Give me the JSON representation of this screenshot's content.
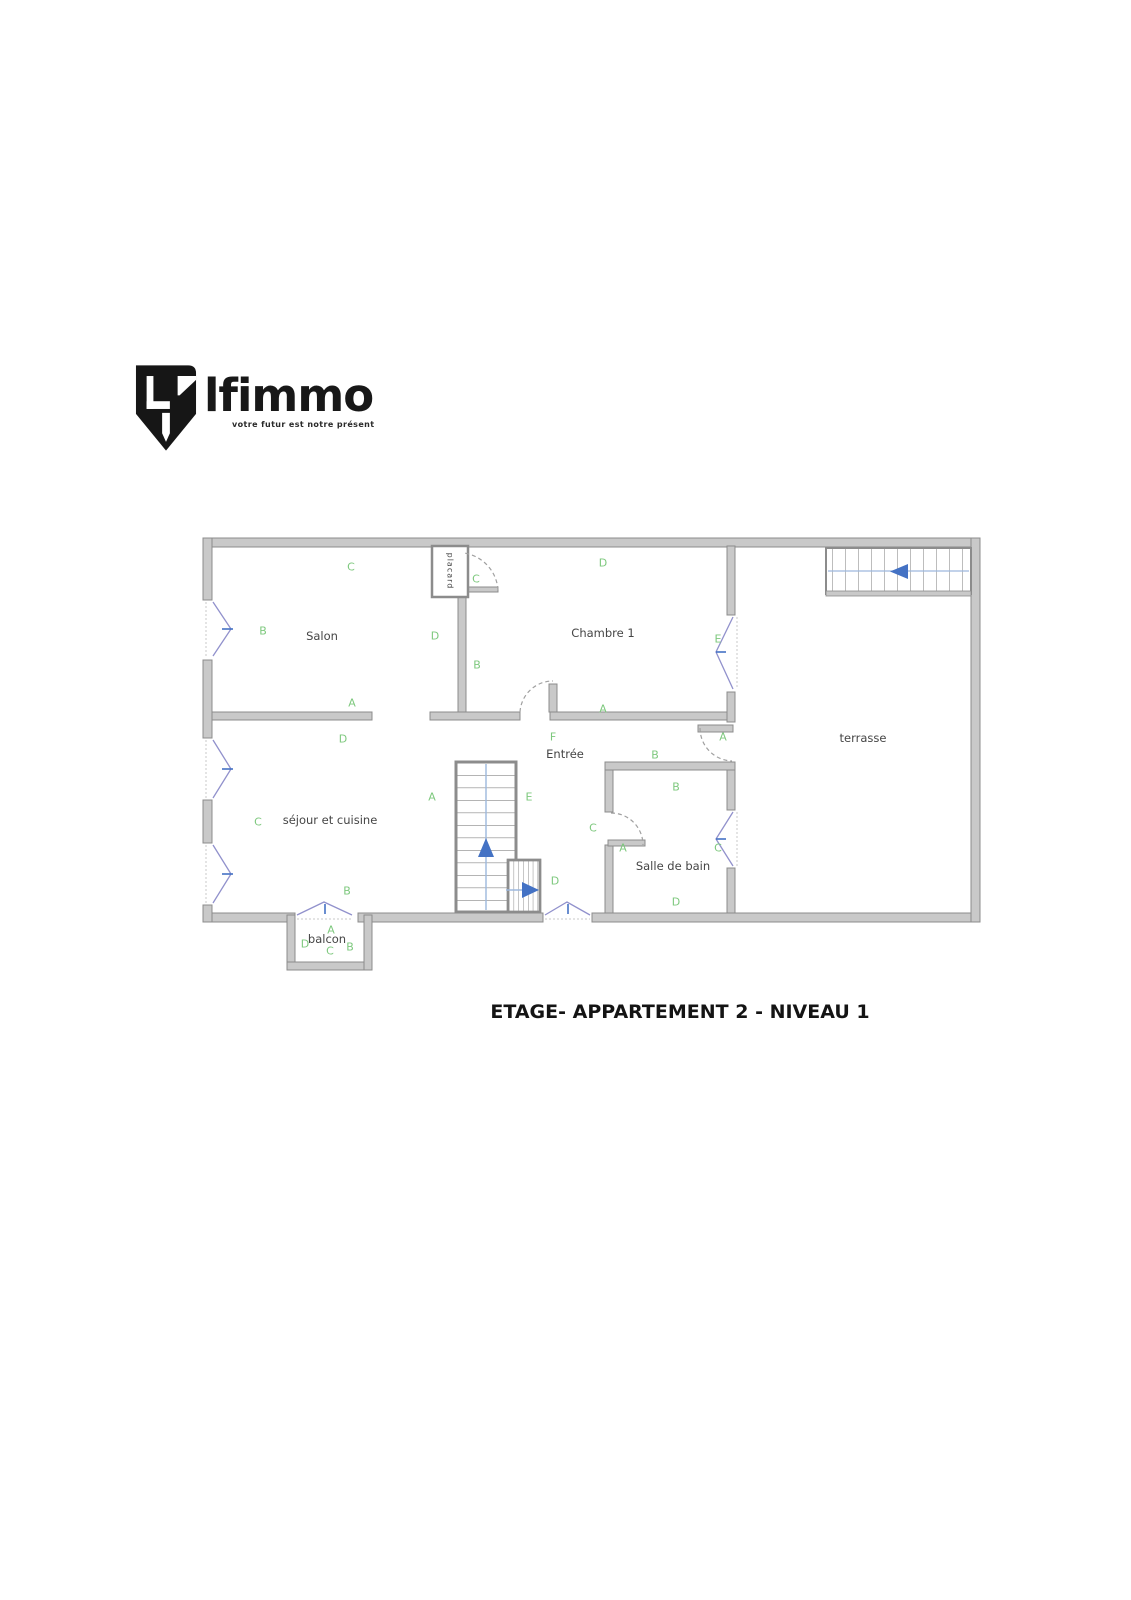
{
  "logo": {
    "brand": "lfimmo",
    "tagline": "votre futur est notre présent"
  },
  "plan": {
    "caption": "ETAGE- APPARTEMENT 2 - NIVEAU 1",
    "rooms": [
      {
        "name": "Salon",
        "x": 322,
        "y": 636
      },
      {
        "name": "Chambre 1",
        "x": 603,
        "y": 633
      },
      {
        "name": "placard",
        "x": 450,
        "y": 571,
        "vertical": true
      },
      {
        "name": "terrasse",
        "x": 863,
        "y": 738
      },
      {
        "name": "Entrée",
        "x": 565,
        "y": 754
      },
      {
        "name": "séjour et cuisine",
        "x": 330,
        "y": 820
      },
      {
        "name": "Salle de bain",
        "x": 673,
        "y": 866
      },
      {
        "name": "balcon",
        "x": 327,
        "y": 939
      }
    ],
    "markers": [
      {
        "letter": "C",
        "x": 351,
        "y": 567
      },
      {
        "letter": "B",
        "x": 263,
        "y": 631
      },
      {
        "letter": "D",
        "x": 435,
        "y": 636
      },
      {
        "letter": "A",
        "x": 352,
        "y": 703
      },
      {
        "letter": "C",
        "x": 476,
        "y": 579
      },
      {
        "letter": "D",
        "x": 603,
        "y": 563
      },
      {
        "letter": "B",
        "x": 477,
        "y": 665
      },
      {
        "letter": "E",
        "x": 718,
        "y": 639
      },
      {
        "letter": "A",
        "x": 603,
        "y": 709
      },
      {
        "letter": "F",
        "x": 553,
        "y": 737
      },
      {
        "letter": "B",
        "x": 655,
        "y": 755
      },
      {
        "letter": "A",
        "x": 723,
        "y": 737
      },
      {
        "letter": "D",
        "x": 343,
        "y": 739
      },
      {
        "letter": "A",
        "x": 432,
        "y": 797
      },
      {
        "letter": "C",
        "x": 258,
        "y": 822
      },
      {
        "letter": "B",
        "x": 347,
        "y": 891
      },
      {
        "letter": "E",
        "x": 529,
        "y": 797
      },
      {
        "letter": "D",
        "x": 555,
        "y": 881
      },
      {
        "letter": "B",
        "x": 676,
        "y": 787
      },
      {
        "letter": "C",
        "x": 593,
        "y": 828
      },
      {
        "letter": "A",
        "x": 623,
        "y": 848
      },
      {
        "letter": "C",
        "x": 718,
        "y": 848
      },
      {
        "letter": "D",
        "x": 676,
        "y": 902
      },
      {
        "letter": "A",
        "x": 331,
        "y": 930
      },
      {
        "letter": "D",
        "x": 305,
        "y": 944
      },
      {
        "letter": "C",
        "x": 330,
        "y": 951
      },
      {
        "letter": "B",
        "x": 350,
        "y": 947
      }
    ],
    "colors": {
      "marker": "#7dc87d",
      "wall_fill": "#c9c9c9",
      "wall_edge": "#8c8c8c",
      "window": "#9191cc",
      "arrow": "#4472c4",
      "stair_line": "#9db8dd",
      "room_text": "#454545"
    }
  }
}
